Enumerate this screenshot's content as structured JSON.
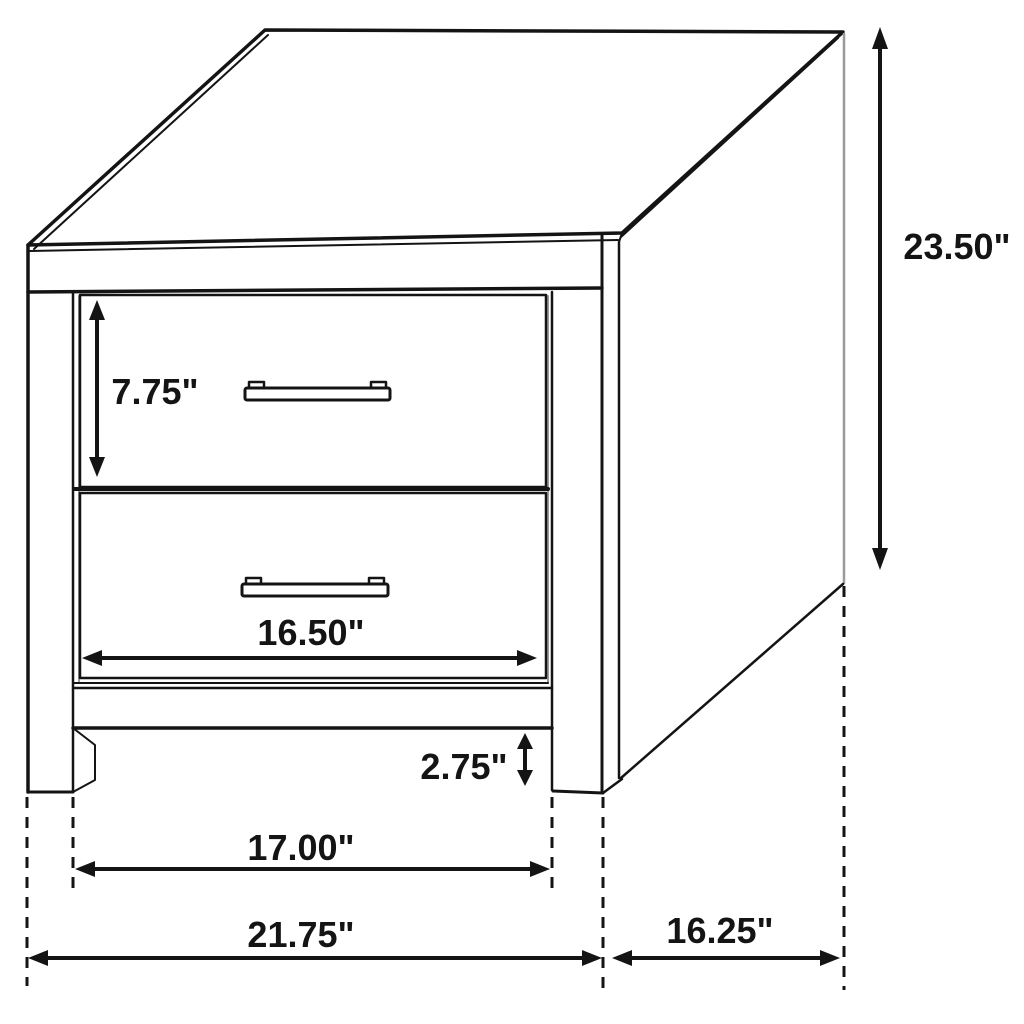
{
  "diagram": {
    "type": "furniture-dimension-diagram",
    "subject": "two-drawer nightstand isometric line drawing",
    "background_color": "#ffffff",
    "line_color": "#141414",
    "muted_line_color": "#9a9a9a",
    "dimensions": [
      {
        "id": "overall-height",
        "label": "23.50\"",
        "orientation": "vertical",
        "x": 880,
        "from": 27,
        "to": 570,
        "label_x": 957,
        "label_y": 259,
        "head": 22
      },
      {
        "id": "top-drawer-height",
        "label": "7.75\"",
        "orientation": "vertical",
        "x": 97,
        "from": 300,
        "to": 477,
        "label_x": 155,
        "label_y": 404,
        "head": 20
      },
      {
        "id": "drawer-width",
        "label": "16.50\"",
        "orientation": "horizontal",
        "y": 658,
        "from": 82,
        "to": 537,
        "label_x": 311,
        "label_y": 645,
        "head": 20
      },
      {
        "id": "leg-height",
        "label": "2.75\"",
        "orientation": "vertical",
        "x": 525,
        "from": 733,
        "to": 786,
        "label_x": 464,
        "label_y": 779,
        "head": 16
      },
      {
        "id": "inner-width",
        "label": "17.00\"",
        "orientation": "horizontal",
        "y": 869,
        "from": 75,
        "to": 550,
        "label_x": 301,
        "label_y": 860,
        "head": 20
      },
      {
        "id": "overall-width",
        "label": "21.75\"",
        "orientation": "horizontal",
        "y": 958,
        "from": 28,
        "to": 602,
        "label_x": 301,
        "label_y": 947,
        "head": 20
      },
      {
        "id": "overall-depth",
        "label": "16.25\"",
        "orientation": "horizontal",
        "y": 958,
        "from": 612,
        "to": 840,
        "label_x": 720,
        "label_y": 943,
        "head": 20
      }
    ],
    "extension_lines": [
      {
        "x": 27,
        "from": 797,
        "to": 986
      },
      {
        "x": 73,
        "from": 797,
        "to": 895
      },
      {
        "x": 552,
        "from": 797,
        "to": 895
      },
      {
        "x": 603,
        "from": 797,
        "to": 992
      },
      {
        "x": 844,
        "from": 586,
        "to": 990
      }
    ]
  }
}
